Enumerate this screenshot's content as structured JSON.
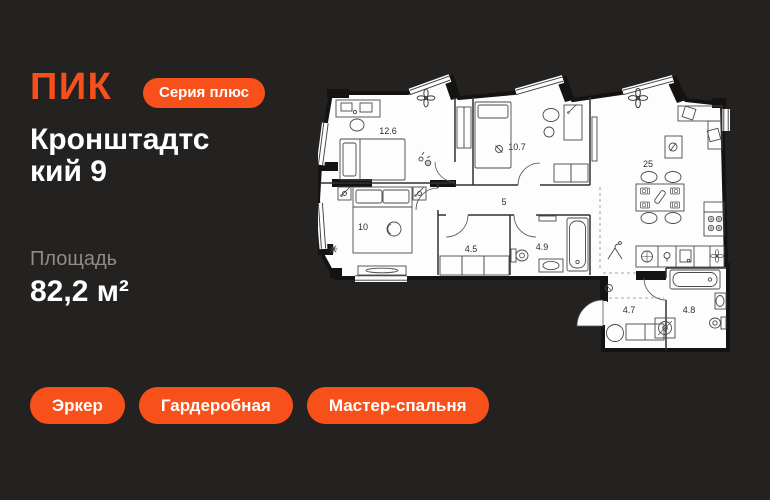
{
  "colors": {
    "accent": "#F8501A",
    "background": "#242220",
    "plan_paper": "#FDFDFD"
  },
  "header": {
    "logo": "ПИК",
    "series_badge": "Серия плюс"
  },
  "listing": {
    "title_line1": "Кронштадтс",
    "title_line2": "кий 9",
    "area_label": "Площадь",
    "area_value": "82,2 м²"
  },
  "tags": [
    {
      "label": "Эркер"
    },
    {
      "label": "Гардеробная"
    },
    {
      "label": "Мастер-спальня"
    }
  ],
  "floorplan": {
    "rooms": [
      {
        "name": "bedroom-1",
        "area": "12.6"
      },
      {
        "name": "bedroom-2",
        "area": "10.7"
      },
      {
        "name": "corridor",
        "area": "5"
      },
      {
        "name": "master-bedroom",
        "area": "10"
      },
      {
        "name": "wardrobe",
        "area": "4.5"
      },
      {
        "name": "bathroom",
        "area": "4.9"
      },
      {
        "name": "living-kitchen",
        "area": "25"
      },
      {
        "name": "entrance-hall",
        "area": "4.7"
      },
      {
        "name": "bathroom-2",
        "area": "4.8"
      }
    ]
  }
}
